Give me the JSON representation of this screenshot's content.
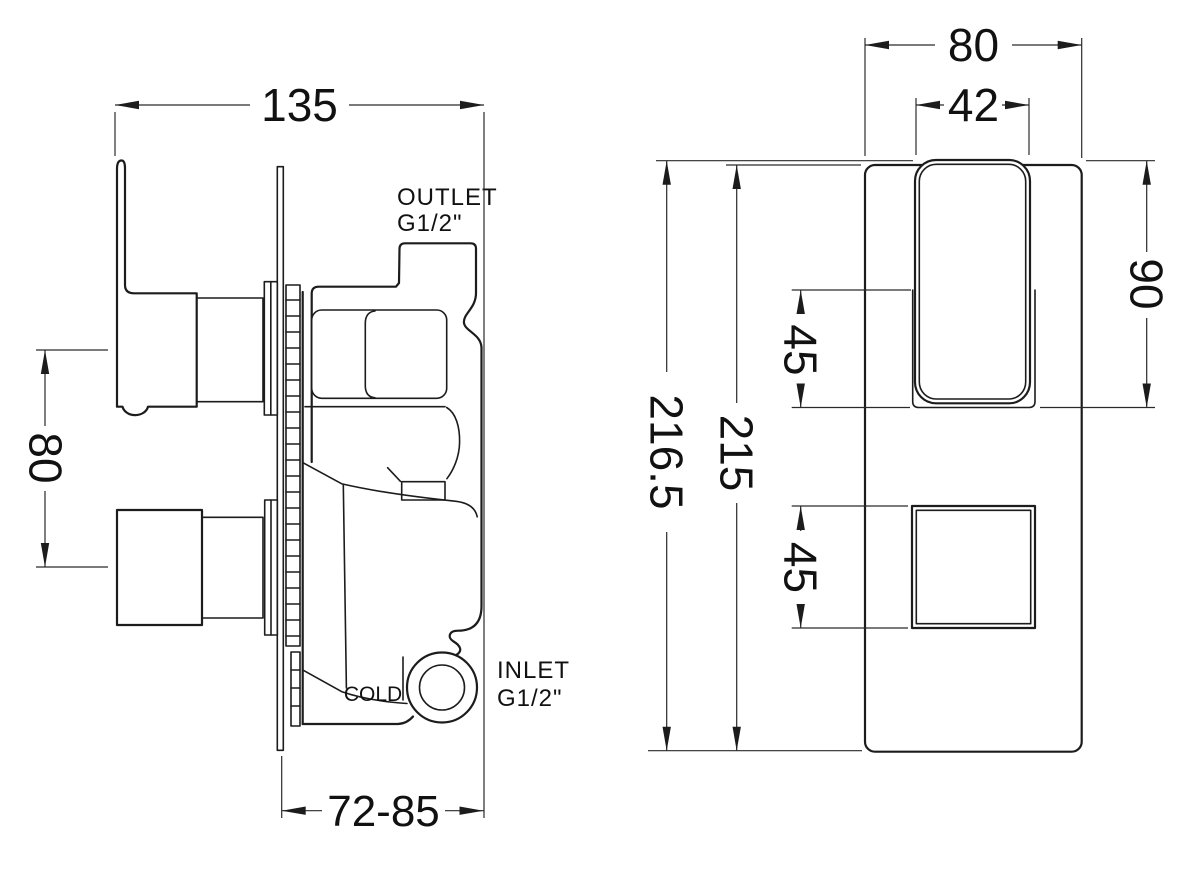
{
  "drawing": {
    "background": "#ffffff",
    "line_color": "#1c1c1c",
    "left_view": {
      "dim_depth": "135",
      "dim_handle_spacing": "80",
      "dim_recess_depth": "72-85",
      "label_outlet": "OUTLET",
      "label_outlet_thread": "G1/2\"",
      "label_inlet": "INLET",
      "label_inlet_thread": "G1/2\"",
      "label_cold": "COLD"
    },
    "right_view": {
      "dim_plate_width": "80",
      "dim_handle_width": "42",
      "dim_handle_height": "90",
      "dim_upper_offset": "45",
      "dim_lower_offset": "45",
      "dim_total_height": "216.5",
      "dim_plate_height": "215"
    }
  }
}
